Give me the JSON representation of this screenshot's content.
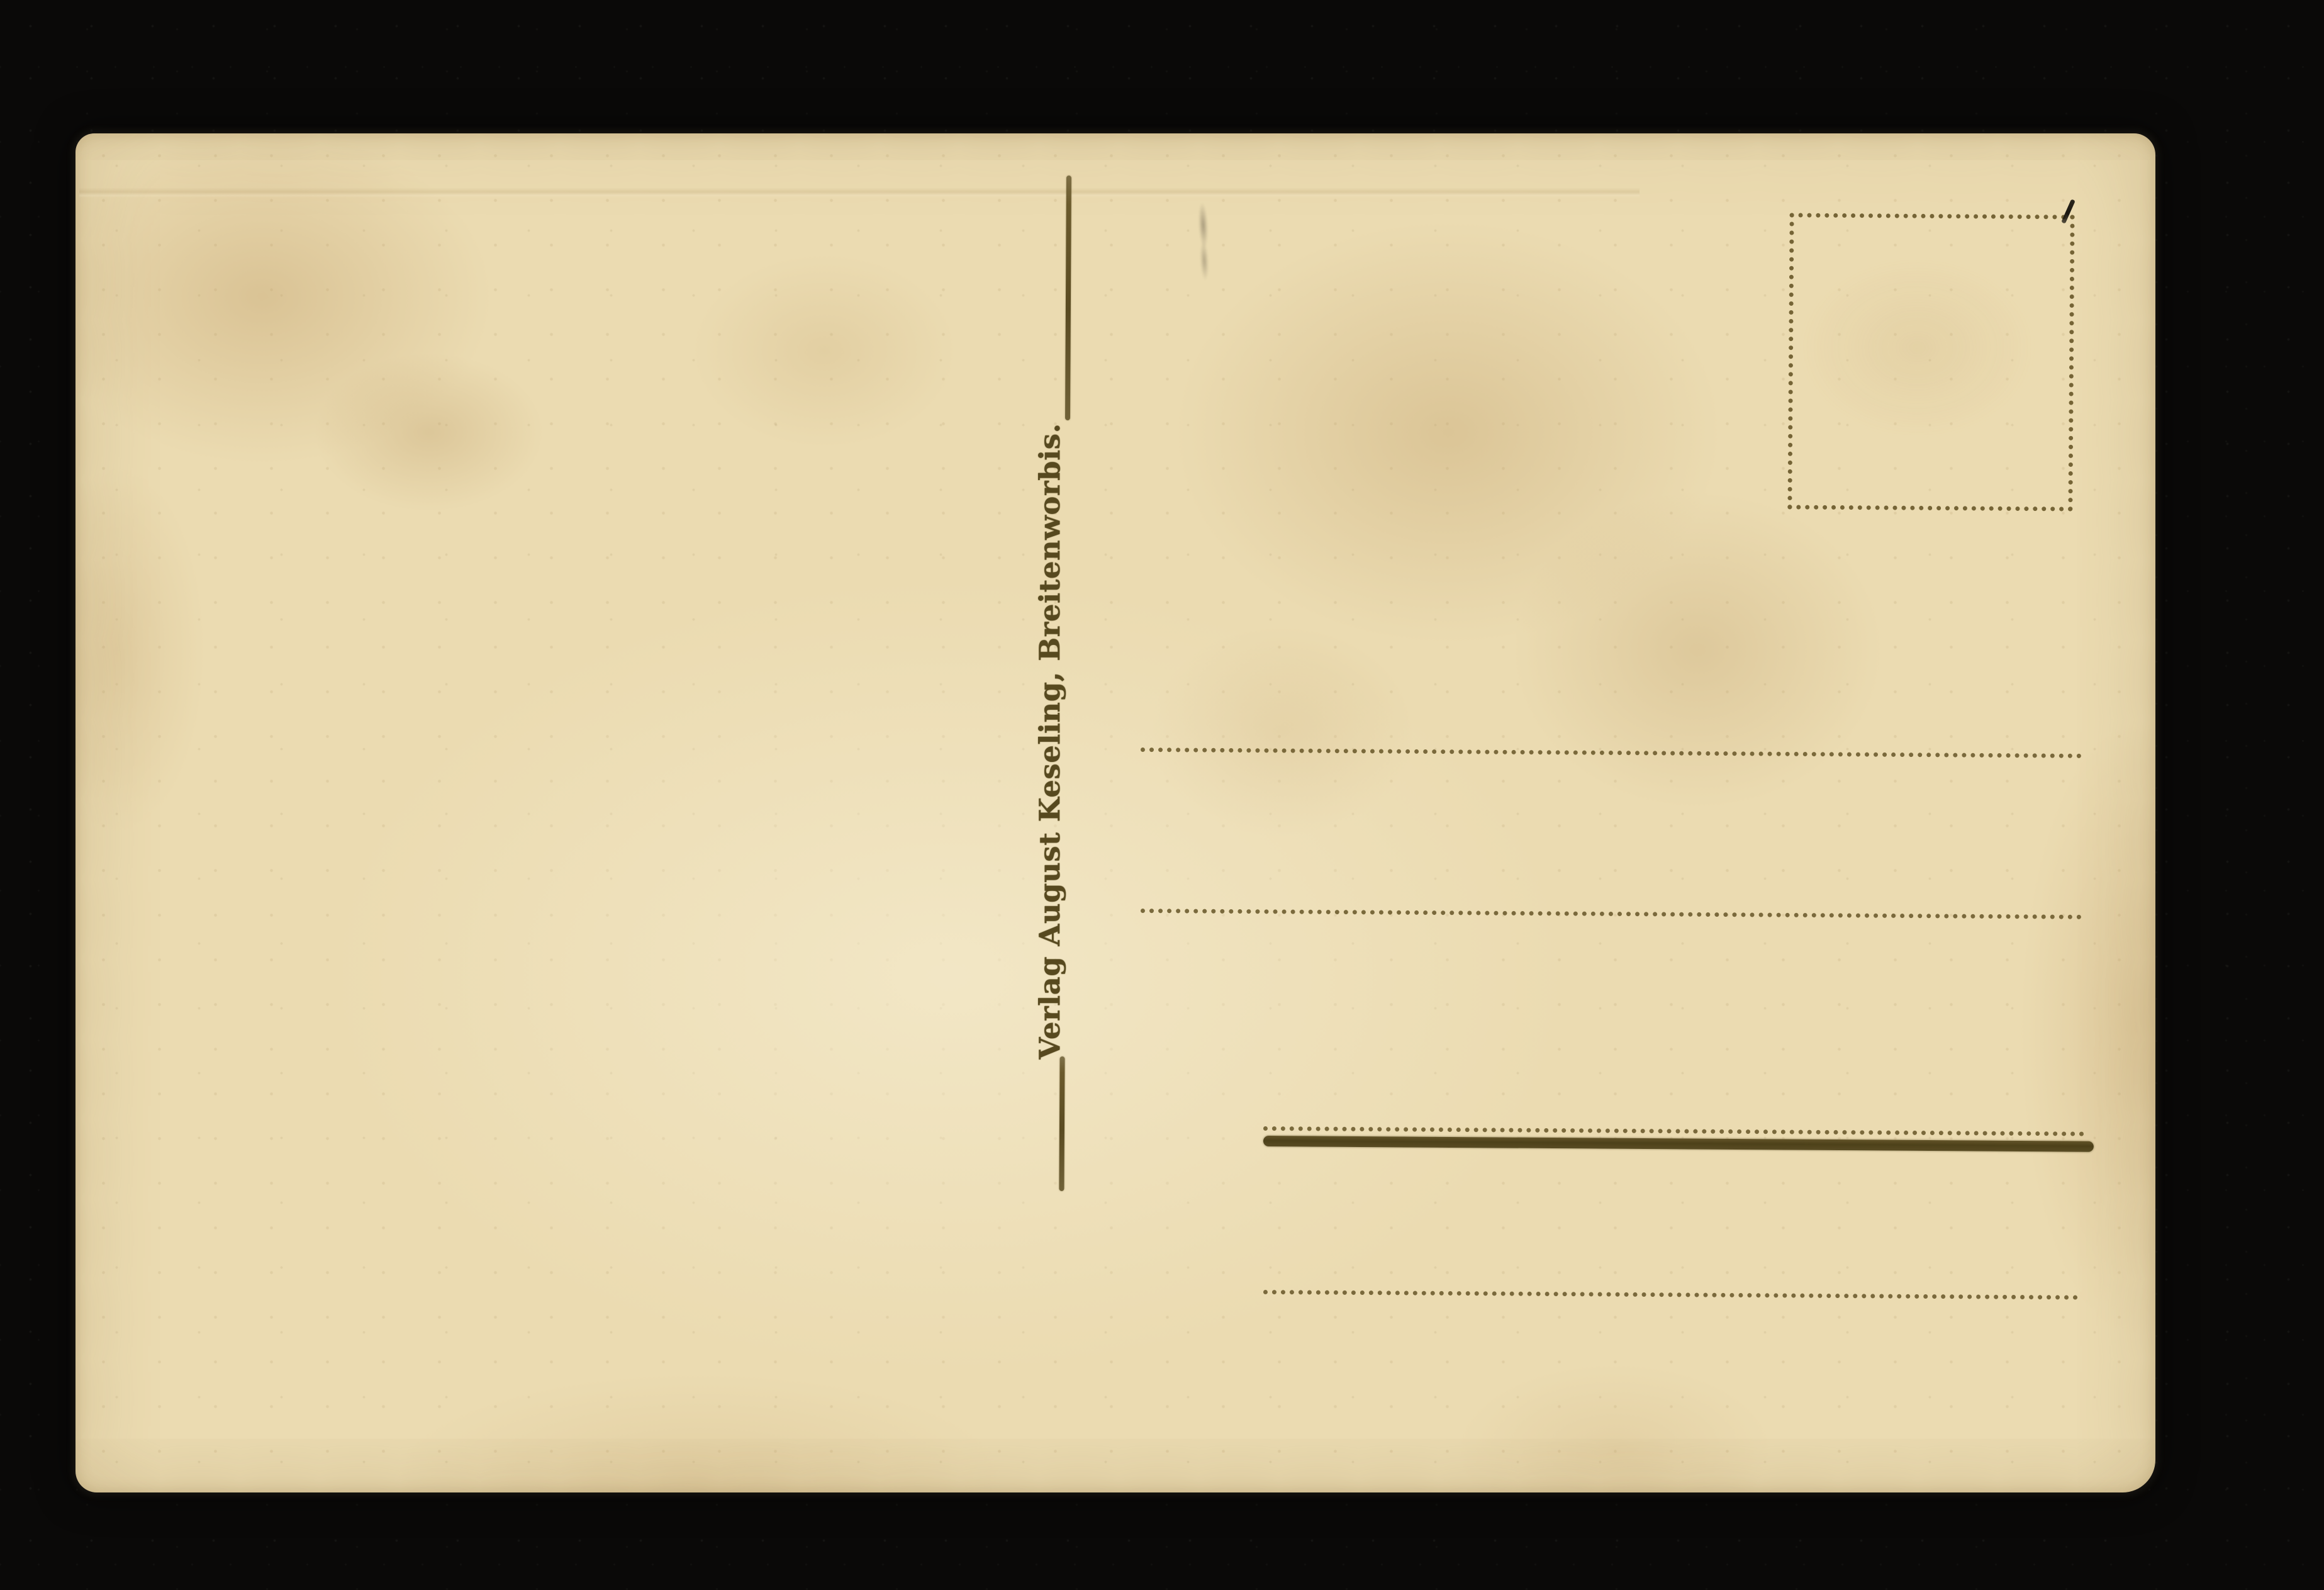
{
  "postcard": {
    "publisher_imprint": "Verlag August Keseling, Breitenworbis.",
    "stamp_box_present": true,
    "address_line_count": 4,
    "writing_present": false
  },
  "colors": {
    "bg": "#0a0908",
    "paper": "#ebdbb1",
    "paper-light": "#f3e8ca",
    "stain": "#c9a873",
    "ink": "#6b5a2c",
    "ink-dark": "#4e4119",
    "pen": "#16130d",
    "pencil": "#6e6250"
  }
}
